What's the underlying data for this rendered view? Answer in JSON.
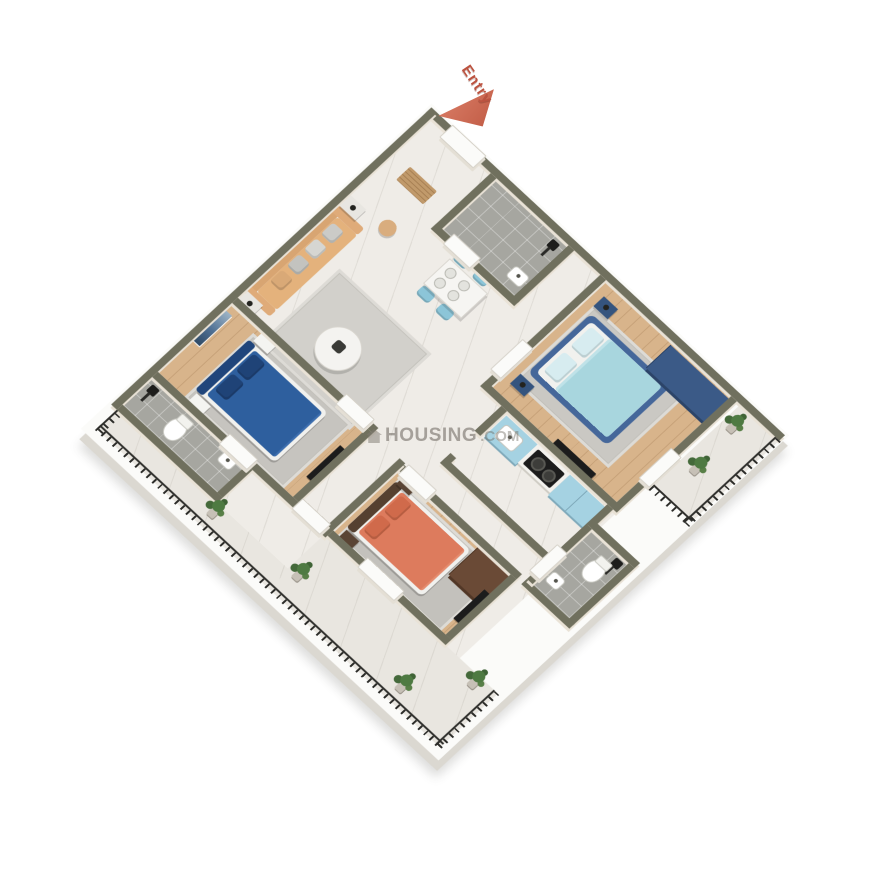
{
  "entry": {
    "label": "Entry",
    "arrow_color": "#cf6a52",
    "text_color": "#bc5340"
  },
  "watermark": {
    "icon": "house-icon",
    "main": "HOUSING",
    "suffix": ".COM"
  },
  "palette": {
    "wall_top": "#70705e",
    "wall_face": "#e9e2d6",
    "marble_floor": "#efece7",
    "wood_floor": "#d8b48b",
    "bathroom_tile": "#a6a6a0",
    "balcony_floor": "#e9e6e0",
    "railing": "#2c2c29",
    "blue_bed": "#2e5f9e",
    "lightblue_bed": "#a8d6de",
    "orange_bed": "#dd7b5d",
    "sofa": "#e4b27c",
    "dining_chair": "#8cc5d8",
    "kitchen_cabinet": "#a5d2e2",
    "wardrobe_blue": "#3b5a87",
    "wardrobe_brown": "#6a4a36",
    "plant": "#4e7a42",
    "background": "#ffffff"
  },
  "scene": {
    "type": "3D isometric apartment floor plan render",
    "rooms": [
      {
        "name": "foyer",
        "floor": "marble",
        "furniture": [
          "entry-door",
          "doormat"
        ]
      },
      {
        "name": "common-bathroom-top",
        "floor": "tile",
        "furniture": [
          "shower",
          "sink",
          "door"
        ]
      },
      {
        "name": "bedroom-light-blue",
        "floor": "wood",
        "furniture": [
          "double-bed-lightblue",
          "rug",
          "two-nightstands",
          "blue-wardrobe",
          "tv",
          "balcony-door"
        ]
      },
      {
        "name": "living-room",
        "floor": "marble",
        "furniture": [
          "tan-sofa",
          "gray-pillows",
          "side-tables-with-lamps",
          "stool",
          "round-coffee-table",
          "rug"
        ]
      },
      {
        "name": "dining-area",
        "floor": "marble",
        "furniture": [
          "white-table",
          "four-blue-chairs",
          "plates"
        ]
      },
      {
        "name": "kitchen",
        "floor": "marble",
        "furniture": [
          "blue-sink-unit",
          "gas-stove-counter",
          "blue-cabinet"
        ]
      },
      {
        "name": "bedroom-blue",
        "floor": "wood",
        "furniture": [
          "double-bed-blue",
          "wall-art",
          "rug",
          "white-nightstands",
          "tv"
        ]
      },
      {
        "name": "bathroom-left",
        "floor": "tile",
        "furniture": [
          "shower",
          "toilet",
          "sink",
          "door"
        ]
      },
      {
        "name": "bedroom-orange",
        "floor": "wood",
        "furniture": [
          "double-bed-orange",
          "rug",
          "brown-nightstands",
          "brown-wardrobe",
          "tv",
          "terrace-door"
        ]
      },
      {
        "name": "bathroom-right",
        "floor": "tile",
        "furniture": [
          "shower",
          "toilet",
          "sink",
          "door"
        ]
      },
      {
        "name": "balcony-right",
        "floor": "marble",
        "furniture": [
          "railing",
          "potted-plants"
        ]
      },
      {
        "name": "terrace-bottom",
        "floor": "marble",
        "furniture": [
          "railing",
          "potted-plants"
        ]
      }
    ]
  }
}
